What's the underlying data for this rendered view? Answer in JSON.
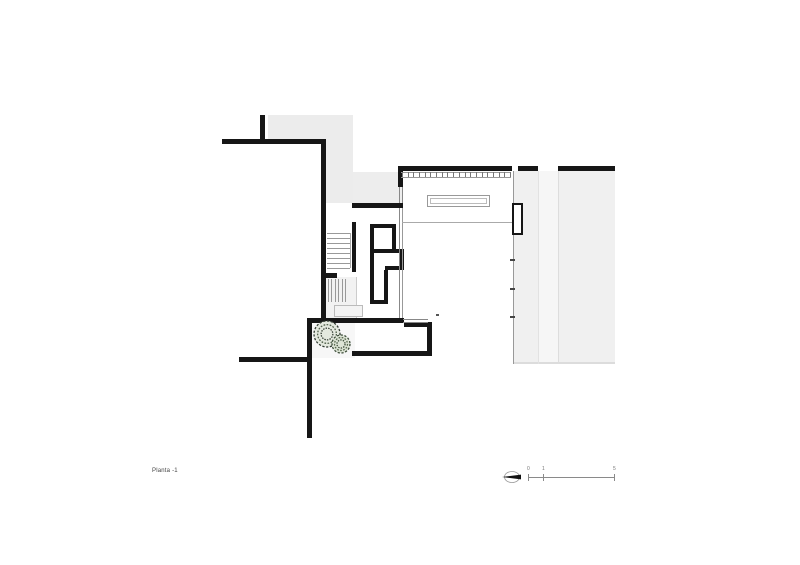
{
  "labels": {
    "plan": "Planta -1"
  },
  "colors": {
    "wall": "#161616",
    "text": "#444444",
    "area_gray": "#ececec",
    "stair_gray": "#f2f2f2",
    "courtyard": "#f7f7f7",
    "terrace": "#f0f0f0",
    "terrace_strip": "#f6f6f6",
    "terrace_edge": "#dcdcdc",
    "tree_dark": "#333d33",
    "tree_mid": "#50604b",
    "tree_fill": "#e4e9df"
  },
  "plan": {
    "fills": [
      {
        "name": "patio-upper-ground",
        "x": 268,
        "y": 115,
        "w": 85,
        "h": 27,
        "fill": "#ececec"
      },
      {
        "name": "patio-upper-ground",
        "x": 326,
        "y": 142,
        "w": 27,
        "h": 61,
        "fill": "#ececec"
      },
      {
        "name": "patio-upper-ground",
        "x": 353,
        "y": 172,
        "w": 50,
        "h": 31,
        "fill": "#ededed"
      },
      {
        "name": "stair-zone-floor",
        "x": 326,
        "y": 277,
        "w": 30,
        "h": 41,
        "fill": "#f2f2f2"
      },
      {
        "name": "courtyard-floor",
        "x": 312,
        "y": 322,
        "w": 43,
        "h": 36,
        "fill": "#f7f7f7"
      },
      {
        "name": "terrace-floor",
        "x": 513,
        "y": 171,
        "w": 102,
        "h": 193,
        "fill": "#f0f0f0"
      },
      {
        "name": "terrace-strip",
        "x": 538,
        "y": 171,
        "w": 20,
        "h": 193,
        "fill": "#f6f6f6"
      },
      {
        "name": "terrace-edge",
        "x": 513,
        "y": 362,
        "w": 102,
        "h": 2,
        "fill": "#dcdcdc"
      }
    ],
    "walls": [
      {
        "name": "wall-stub-top",
        "x": 260,
        "y": 115,
        "w": 5,
        "h": 27
      },
      {
        "name": "wall-top-left",
        "x": 222,
        "y": 139,
        "w": 104,
        "h": 5
      },
      {
        "name": "wall-left-boundary",
        "x": 321,
        "y": 139,
        "w": 5,
        "h": 183
      },
      {
        "name": "wall-court-top",
        "x": 308,
        "y": 318,
        "w": 96,
        "h": 5
      },
      {
        "name": "wall-room-top-jog",
        "x": 404,
        "y": 322,
        "w": 28,
        "h": 5
      },
      {
        "name": "wall-room-right",
        "x": 427,
        "y": 327,
        "w": 5,
        "h": 29
      },
      {
        "name": "wall-room-bottom",
        "x": 352,
        "y": 351,
        "w": 80,
        "h": 5
      },
      {
        "name": "wall-left-lower",
        "x": 307,
        "y": 318,
        "w": 5,
        "h": 120
      },
      {
        "name": "wall-bottom-left",
        "x": 239,
        "y": 357,
        "w": 70,
        "h": 5
      },
      {
        "name": "wall-core-top",
        "x": 352,
        "y": 203,
        "w": 51,
        "h": 5
      },
      {
        "name": "wall-core-left",
        "x": 352,
        "y": 222,
        "w": 4,
        "h": 50
      },
      {
        "name": "wall-core-inner-left",
        "x": 370,
        "y": 224,
        "w": 4,
        "h": 80
      },
      {
        "name": "wall-core-inner-top",
        "x": 370,
        "y": 224,
        "w": 26,
        "h": 4
      },
      {
        "name": "wall-core-inner-right-up",
        "x": 392,
        "y": 228,
        "w": 4,
        "h": 24
      },
      {
        "name": "wall-core-mid",
        "x": 374,
        "y": 249,
        "w": 30,
        "h": 4
      },
      {
        "name": "wall-core-nook-right",
        "x": 400,
        "y": 253,
        "w": 4,
        "h": 17
      },
      {
        "name": "wall-core-nook-bottom",
        "x": 385,
        "y": 266,
        "w": 19,
        "h": 4
      },
      {
        "name": "wall-core-inner-right-low",
        "x": 384,
        "y": 270,
        "w": 4,
        "h": 34
      },
      {
        "name": "wall-core-inner-bottom",
        "x": 370,
        "y": 300,
        "w": 18,
        "h": 4
      },
      {
        "name": "wall-main-top",
        "x": 398,
        "y": 166,
        "w": 114,
        "h": 5
      },
      {
        "name": "wall-main-left-top",
        "x": 398,
        "y": 166,
        "w": 5,
        "h": 21
      },
      {
        "name": "wall-top-right-a",
        "x": 518,
        "y": 166,
        "w": 20,
        "h": 5
      },
      {
        "name": "wall-top-right-b",
        "x": 558,
        "y": 166,
        "w": 57,
        "h": 5
      },
      {
        "name": "wall-stair-stub",
        "x": 321,
        "y": 273,
        "w": 16,
        "h": 5
      }
    ],
    "lines": [
      {
        "name": "window-line",
        "x": 399,
        "y": 187,
        "w": 1,
        "h": 16,
        "c": "#888888"
      },
      {
        "name": "window-line",
        "x": 402,
        "y": 187,
        "w": 1,
        "h": 16,
        "c": "#888888"
      },
      {
        "name": "window-line",
        "x": 399,
        "y": 208,
        "w": 1,
        "h": 110,
        "c": "#888888"
      },
      {
        "name": "window-line",
        "x": 402,
        "y": 208,
        "w": 1,
        "h": 110,
        "c": "#999999"
      },
      {
        "name": "floor-line",
        "x": 402,
        "y": 222,
        "w": 111,
        "h": 1,
        "c": "#aaaaaa"
      },
      {
        "name": "room-right-edge",
        "x": 513,
        "y": 171,
        "w": 1,
        "h": 193,
        "c": "#999999"
      },
      {
        "name": "terrace-joint",
        "x": 538,
        "y": 171,
        "w": 1,
        "h": 193,
        "c": "#e2e2e2"
      },
      {
        "name": "terrace-joint",
        "x": 558,
        "y": 171,
        "w": 1,
        "h": 193,
        "c": "#dddddd"
      },
      {
        "name": "mullion-rail",
        "x": 401,
        "y": 172,
        "w": 110,
        "h": 1,
        "c": "#999999"
      },
      {
        "name": "mullion-rail",
        "x": 401,
        "y": 177,
        "w": 110,
        "h": 1,
        "c": "#999999"
      },
      {
        "name": "window-line",
        "x": 403,
        "y": 319,
        "w": 25,
        "h": 1,
        "c": "#888888"
      },
      {
        "name": "window-line",
        "x": 403,
        "y": 322,
        "w": 25,
        "h": 1,
        "c": "#888888"
      },
      {
        "name": "stair-edge",
        "x": 350,
        "y": 233,
        "w": 1,
        "h": 35,
        "c": "#aaaaaa"
      },
      {
        "name": "stair-edge",
        "x": 356,
        "y": 277,
        "w": 1,
        "h": 41,
        "c": "#cccccc"
      },
      {
        "name": "hinge-mark",
        "x": 510,
        "y": 259,
        "w": 5,
        "h": 2,
        "c": "#444444"
      },
      {
        "name": "hinge-mark",
        "x": 510,
        "y": 288,
        "w": 5,
        "h": 2,
        "c": "#444444"
      },
      {
        "name": "hinge-mark",
        "x": 510,
        "y": 316,
        "w": 5,
        "h": 2,
        "c": "#444444"
      },
      {
        "name": "survey-mark",
        "x": 436,
        "y": 314,
        "w": 3,
        "h": 2,
        "c": "#555555"
      }
    ],
    "boxes": [
      {
        "name": "skylight-outline",
        "x": 427,
        "y": 195,
        "w": 63,
        "h": 12,
        "bw": 1,
        "c": "#999999",
        "fill": "transparent"
      },
      {
        "name": "skylight-outline",
        "x": 430,
        "y": 198,
        "w": 57,
        "h": 6,
        "bw": 1,
        "c": "#bbbbbb",
        "fill": "transparent"
      },
      {
        "name": "chimney-box",
        "x": 512,
        "y": 203,
        "w": 11,
        "h": 32,
        "bw": 2,
        "c": "#161616",
        "fill": "#ffffff"
      },
      {
        "name": "stair-landing",
        "x": 334,
        "y": 305,
        "w": 29,
        "h": 12,
        "bw": 1,
        "c": "#bbbbbb",
        "fill": "#f3f3f3"
      }
    ],
    "tick_rows": [
      {
        "name": "window-mullions",
        "x1": 402,
        "x2": 510,
        "y": 172,
        "h": 5,
        "count": 20,
        "c": "#777777"
      }
    ],
    "stair_runs": [
      {
        "name": "stair-upper",
        "orient": "h",
        "x": 327,
        "len": 23,
        "a1": 233,
        "a2": 268,
        "count": 8,
        "c": "#999999"
      },
      {
        "name": "stair-lower",
        "orient": "v",
        "y": 279,
        "len": 23,
        "a1": 328,
        "a2": 345,
        "count": 6,
        "c": "#999999"
      }
    ],
    "tree": {
      "x": 310,
      "y": 320,
      "w": 44,
      "h": 38,
      "blobs": [
        {
          "cx": 327,
          "cy": 334,
          "r": 13,
          "strokes": [
            "#333d33",
            "#50604b",
            "#333d33"
          ],
          "fill": "#e4e9df"
        },
        {
          "cx": 341,
          "cy": 344,
          "r": 9,
          "strokes": [
            "#3d4d3a",
            "#5a6b50",
            "#3d4d3a"
          ],
          "fill": "#dde4d6"
        }
      ]
    }
  },
  "scalebar": {
    "y": 477,
    "x_start": 528,
    "x_end": 614,
    "c": "#8a8a8a",
    "ticks": [
      {
        "label": "0",
        "x": 528
      },
      {
        "label": "1",
        "x": 543
      },
      {
        "label": "5",
        "x": 614
      }
    ]
  },
  "north": {
    "cx": 511,
    "cy": 477
  }
}
